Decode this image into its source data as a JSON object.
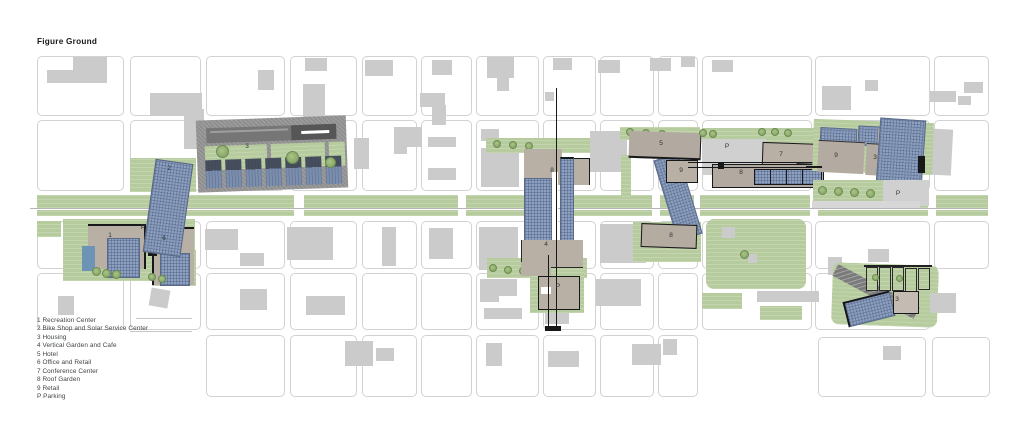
{
  "title": "Figure Ground",
  "legend": {
    "items": [
      {
        "key": "1",
        "name": "Recreation Center"
      },
      {
        "key": "2",
        "name": "Bike Shop and Solar Service Center"
      },
      {
        "key": "3",
        "name": "Housing"
      },
      {
        "key": "4",
        "name": "Vertical Garden and Cafe"
      },
      {
        "key": "5",
        "name": "Hotel"
      },
      {
        "key": "6",
        "name": "Office and Retail"
      },
      {
        "key": "7",
        "name": "Conference Center"
      },
      {
        "key": "8",
        "name": "Roof Garden"
      },
      {
        "key": "9",
        "name": "Retail"
      },
      {
        "key": "P",
        "name": "Parking"
      }
    ]
  },
  "map": {
    "labels": [
      {
        "id": "bike-shop-tower",
        "text": "2"
      },
      {
        "id": "housing-north",
        "text": "3"
      },
      {
        "id": "recreation-center",
        "text": "1"
      },
      {
        "id": "parking-west",
        "text": "P"
      },
      {
        "id": "office-and-retail",
        "text": "6"
      },
      {
        "id": "roof-garden-center-north",
        "text": "8"
      },
      {
        "id": "vertical-garden-cafe",
        "text": "4"
      },
      {
        "id": "parking-center-south",
        "text": "P"
      },
      {
        "id": "hotel",
        "text": "5"
      },
      {
        "id": "retail-center",
        "text": "9"
      },
      {
        "id": "roof-garden-center-south",
        "text": "8"
      },
      {
        "id": "parking-mid",
        "text": "P"
      },
      {
        "id": "conference-center",
        "text": "7"
      },
      {
        "id": "roof-garden-east",
        "text": "8"
      },
      {
        "id": "retail-east",
        "text": "9"
      },
      {
        "id": "housing-east",
        "text": "3"
      },
      {
        "id": "parking-east",
        "text": "P"
      },
      {
        "id": "housing-southeast",
        "text": "3"
      }
    ],
    "colors": {
      "landscape_green": "#b6cb9e",
      "context_gray": "#cbcbcb",
      "highlight_tan": "#b8afa5",
      "solar_panel_blue": "#8da0c0",
      "section_line_black": "#17181a"
    }
  }
}
